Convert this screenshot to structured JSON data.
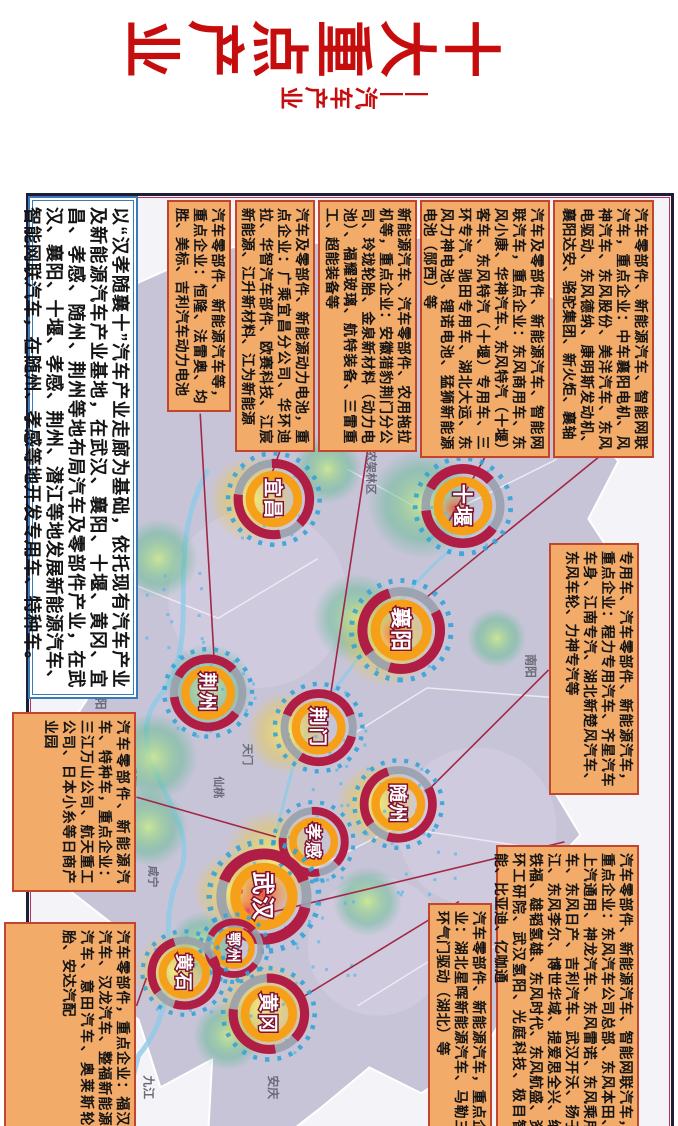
{
  "title": {
    "text": "十大重点产业",
    "subtitle": "——汽车产业",
    "color": "#c60d0e"
  },
  "colors": {
    "box_bg": "#f3ab69",
    "box_border": "#c2452e",
    "frame": "#1d1d35",
    "crimson_ring": "#b01d45",
    "orange_ring": "#f6a01a",
    "dash_blue": "#35a3d8",
    "province_fill": "#c7c4d8",
    "connector": "#a22746"
  },
  "callouts": [
    {
      "id": "xiangyang",
      "style": "orange",
      "x": 200,
      "y": 24,
      "w": 258,
      "h": 101,
      "fs": 14,
      "text": "汽车零部件、新能源汽车、智能网联汽车，重点企业：中车襄阳电机、风神汽车、东风股份、美洋汽车、东风电驱动、东风德纳、康明斯发动机、襄阳达安、骆驼集团、新火炬、襄轴"
    },
    {
      "id": "shiyan",
      "style": "orange",
      "x": 200,
      "y": 128,
      "w": 258,
      "h": 130,
      "fs": 14,
      "text": "汽车及零部件、新能源汽车、智能网联汽车，重点企业：东风商用车、东风小康、华神汽车、东风特汽（十堰）客车、东风特汽（十堰）专用车、三环专汽、驰田专用车、湖北大运、东风力神电池、锂诺电池、猛狮新能源电池（郧西）等"
    },
    {
      "id": "jingmen",
      "style": "orange",
      "x": 200,
      "y": 261,
      "w": 252,
      "h": 99,
      "fs": 14,
      "text": "新能源汽车、汽车零部件、农用拖拉机等，重点企业：安徽猎豹荆门分公司、玲珑轮胎、金泉新材料（动力电池）、福耀玻璃、航特装备、三雷重工、超能装备等"
    },
    {
      "id": "yichang",
      "style": "orange",
      "x": 200,
      "y": 363,
      "w": 252,
      "h": 80,
      "fs": 14,
      "text": "汽车及零部件、新能源动力电池，重点企业：广乘宜昌分公司、华环迪拉、华智汽车部件、欧赛科技、江宸新能源、江升新材料、江为新能源"
    },
    {
      "id": "jingzhou",
      "style": "orange",
      "x": 200,
      "y": 447,
      "w": 212,
      "h": 64,
      "fs": 14,
      "text": "汽车零部件、新能源汽车等，重点企业：恒隆、法雷奥、均胜、美标、吉利汽车动力电池"
    },
    {
      "id": "intro",
      "style": "intro",
      "x": 196,
      "y": 540,
      "w": 503,
      "h": 110,
      "fs": 18,
      "text": "以“汉孝随襄十”汽车产业走廊为基础，依托现有汽车产业及新能源汽车产业基地，在武汉、襄阳、十堰、黄冈、宜昌、孝感、随州、荆州等地布局汽车及零部件产业，在武汉、襄阳、十堰、孝感、荆州、潜江等地发展新能源汽车、智能网联汽车，在随州、孝感等地开发专用车、特种车。"
    },
    {
      "id": "xiaogan",
      "style": "orange",
      "x": 712,
      "y": 542,
      "w": 180,
      "h": 124,
      "fs": 14,
      "text": "汽车零部件、新能源汽车、特种车，重点企业：三江万山公司、航天重工公司、日本小糸等日商产业园"
    },
    {
      "id": "huangshi",
      "style": "orange",
      "x": 922,
      "y": 542,
      "w": 212,
      "h": 132,
      "fs": 14,
      "text": "汽车零部件，重点企业：福汉汽车、汉龙汽车、整福新能源汽车、意田汽车、奥莱斯轮胎、安达汽配"
    },
    {
      "id": "suizhou",
      "style": "orange",
      "x": 543,
      "y": 39,
      "w": 252,
      "h": 90,
      "fs": 14,
      "text": "专用车、汽车零部件、新能源汽车，重点企业：程力专用汽车、齐星汽车车身、江南专汽、湖北新楚风汽车、东风车轮、力神专汽等"
    },
    {
      "id": "wuhan",
      "style": "orange",
      "x": 845,
      "y": 39,
      "w": 297,
      "h": 143,
      "fs": 14,
      "text": "汽车零部件、新能源汽车、智能网联汽车，重点企业：东风汽车公司总部、东风本田、上汽通用、神龙汽车、东风雷诺、东风乘用车、东风日产、吉利汽车、武汉开沃、扬子江、东风李尔、博世华域、提爱思全兴、纳铁福、雄韬氢雄、东风时代、东风航盛、资环工研院、武汉氢阳、光庭科技、极目智能、比亚迪、亿咖通"
    },
    {
      "id": "huanggang",
      "style": "orange",
      "x": 903,
      "y": 186,
      "w": 239,
      "h": 64,
      "fs": 14,
      "text": "汽车零部件、新能源汽车，重点企业：湖北星晖新能源汽车、马勒三环气门驱动（湖北）等"
    }
  ],
  "map": {
    "cities": [
      {
        "name": "十堰",
        "x": 507,
        "y": 214,
        "r": 48
      },
      {
        "name": "襄阳",
        "x": 632,
        "y": 276,
        "r": 50
      },
      {
        "name": "宜昌",
        "x": 500,
        "y": 404,
        "r": 46
      },
      {
        "name": "荆门",
        "x": 730,
        "y": 359,
        "r": 44
      },
      {
        "name": "荆州",
        "x": 695,
        "y": 470,
        "r": 44
      },
      {
        "name": "随州",
        "x": 807,
        "y": 279,
        "r": 44
      },
      {
        "name": "孝感",
        "x": 845,
        "y": 364,
        "r": 40
      },
      {
        "name": "武汉",
        "x": 900,
        "y": 414,
        "r": 55
      },
      {
        "name": "鄂州",
        "x": 952,
        "y": 444,
        "r": 34
      },
      {
        "name": "黄石",
        "x": 977,
        "y": 494,
        "r": 42
      },
      {
        "name": "黄冈",
        "x": 1018,
        "y": 409,
        "r": 46
      }
    ],
    "labels": [
      {
        "t": "神农架林区",
        "x": 468,
        "y": 310,
        "s": 11,
        "c": "#565666"
      },
      {
        "t": "南阳",
        "x": 668,
        "y": 150,
        "s": 12,
        "c": "#8a8a95"
      },
      {
        "t": "岳阳",
        "x": 778,
        "y": 552,
        "s": 12,
        "c": "#8a8a95"
      },
      {
        "t": "益阳",
        "x": 700,
        "y": 582,
        "s": 12,
        "c": "#8a8a95"
      },
      {
        "t": "九江",
        "x": 1092,
        "y": 534,
        "s": 12,
        "c": "#8a8a95"
      },
      {
        "t": "安庆",
        "x": 1092,
        "y": 409,
        "s": 12,
        "c": "#8a8a95"
      },
      {
        "t": "咸宁",
        "x": 880,
        "y": 529,
        "s": 11,
        "c": "#565666"
      },
      {
        "t": "天门",
        "x": 757,
        "y": 434,
        "s": 11,
        "c": "#565666"
      },
      {
        "t": "仙桃",
        "x": 790,
        "y": 463,
        "s": 11,
        "c": "#565666"
      }
    ],
    "connectors": [
      [
        458,
        78,
        600,
        252
      ],
      [
        458,
        192,
        522,
        228
      ],
      [
        452,
        310,
        697,
        347
      ],
      [
        452,
        398,
        480,
        408
      ],
      [
        414,
        478,
        662,
        464
      ],
      [
        800,
        542,
        840,
        402
      ],
      [
        1010,
        542,
        982,
        532
      ],
      [
        672,
        128,
        792,
        248
      ],
      [
        845,
        112,
        922,
        432
      ],
      [
        905,
        218,
        1003,
        378
      ]
    ],
    "outline": [
      [
        300,
        118
      ],
      [
        345,
        78
      ],
      [
        415,
        96
      ],
      [
        462,
        58
      ],
      [
        520,
        88
      ],
      [
        575,
        52
      ],
      [
        618,
        92
      ],
      [
        660,
        62
      ],
      [
        698,
        106
      ],
      [
        745,
        82
      ],
      [
        788,
        126
      ],
      [
        838,
        96
      ],
      [
        872,
        128
      ],
      [
        918,
        76
      ],
      [
        958,
        42
      ],
      [
        1002,
        66
      ],
      [
        1032,
        118
      ],
      [
        1012,
        168
      ],
      [
        1062,
        198
      ],
      [
        1098,
        256
      ],
      [
        1072,
        308
      ],
      [
        1112,
        356
      ],
      [
        1140,
        392
      ],
      [
        1140,
        470
      ],
      [
        1064,
        466
      ],
      [
        1092,
        518
      ],
      [
        1024,
        540
      ],
      [
        992,
        582
      ],
      [
        934,
        558
      ],
      [
        884,
        622
      ],
      [
        822,
        584
      ],
      [
        764,
        632
      ],
      [
        702,
        592
      ],
      [
        662,
        644
      ],
      [
        602,
        612
      ],
      [
        542,
        648
      ],
      [
        474,
        622
      ],
      [
        404,
        642
      ],
      [
        334,
        592
      ],
      [
        282,
        540
      ],
      [
        252,
        472
      ],
      [
        236,
        392
      ],
      [
        252,
        310
      ],
      [
        232,
        242
      ],
      [
        272,
        172
      ]
    ],
    "patches": [
      {
        "x": 830,
        "y": 200,
        "r": 80
      },
      {
        "x": 600,
        "y": 420,
        "r": 90
      },
      {
        "x": 950,
        "y": 300,
        "r": 70
      }
    ],
    "blobs": [
      {
        "x": 505,
        "y": 255,
        "r": 55,
        "k": "g"
      },
      {
        "x": 620,
        "y": 320,
        "r": 45,
        "k": "g"
      },
      {
        "x": 690,
        "y": 470,
        "r": 45,
        "k": "g"
      },
      {
        "x": 560,
        "y": 520,
        "r": 40,
        "k": "g"
      },
      {
        "x": 760,
        "y": 525,
        "r": 45,
        "k": "g"
      },
      {
        "x": 830,
        "y": 530,
        "r": 40,
        "k": "g"
      },
      {
        "x": 905,
        "y": 310,
        "r": 35,
        "k": "g"
      },
      {
        "x": 640,
        "y": 180,
        "r": 30,
        "k": "g"
      },
      {
        "x": 950,
        "y": 475,
        "r": 35,
        "k": "g"
      },
      {
        "x": 1040,
        "y": 450,
        "r": 35,
        "k": "g"
      },
      {
        "x": 470,
        "y": 350,
        "r": 35,
        "k": "g"
      },
      {
        "x": 640,
        "y": 290,
        "r": 50,
        "k": "y"
      },
      {
        "x": 500,
        "y": 425,
        "r": 45,
        "k": "y"
      },
      {
        "x": 735,
        "y": 390,
        "r": 42,
        "k": "y"
      },
      {
        "x": 807,
        "y": 300,
        "r": 42,
        "k": "y"
      },
      {
        "x": 862,
        "y": 405,
        "r": 50,
        "k": "y"
      },
      {
        "x": 1012,
        "y": 415,
        "r": 48,
        "k": "y"
      },
      {
        "x": 975,
        "y": 505,
        "r": 40,
        "k": "y"
      },
      {
        "x": 895,
        "y": 445,
        "r": 40,
        "k": "y"
      },
      {
        "x": 898,
        "y": 415,
        "r": 30,
        "k": "r"
      },
      {
        "x": 636,
        "y": 282,
        "r": 20,
        "k": "r"
      },
      {
        "x": 510,
        "y": 222,
        "r": 16,
        "k": "r"
      },
      {
        "x": 915,
        "y": 430,
        "r": 18,
        "k": "r"
      }
    ],
    "rivers": [
      "M470,470 C560,520 640,470 700,520 C760,565 820,470 880,500 C940,525 1000,490 1060,540 L1140,560",
      "M520,180 C560,260 640,300 700,350 C760,395 820,390 872,415"
    ],
    "clusters": [
      [
        507,
        214
      ],
      [
        632,
        276
      ],
      [
        500,
        404
      ],
      [
        730,
        359
      ],
      [
        695,
        470
      ],
      [
        807,
        279
      ],
      [
        845,
        364
      ],
      [
        900,
        414
      ],
      [
        977,
        494
      ],
      [
        1018,
        409
      ],
      [
        700,
        450
      ],
      [
        770,
        340
      ],
      [
        610,
        500
      ],
      [
        860,
        250
      ],
      [
        940,
        350
      ]
    ],
    "urban_squares": [
      [
        886,
        402
      ],
      [
        898,
        422
      ],
      [
        908,
        408
      ],
      [
        893,
        435
      ],
      [
        912,
        428
      ],
      [
        880,
        418
      ]
    ]
  }
}
